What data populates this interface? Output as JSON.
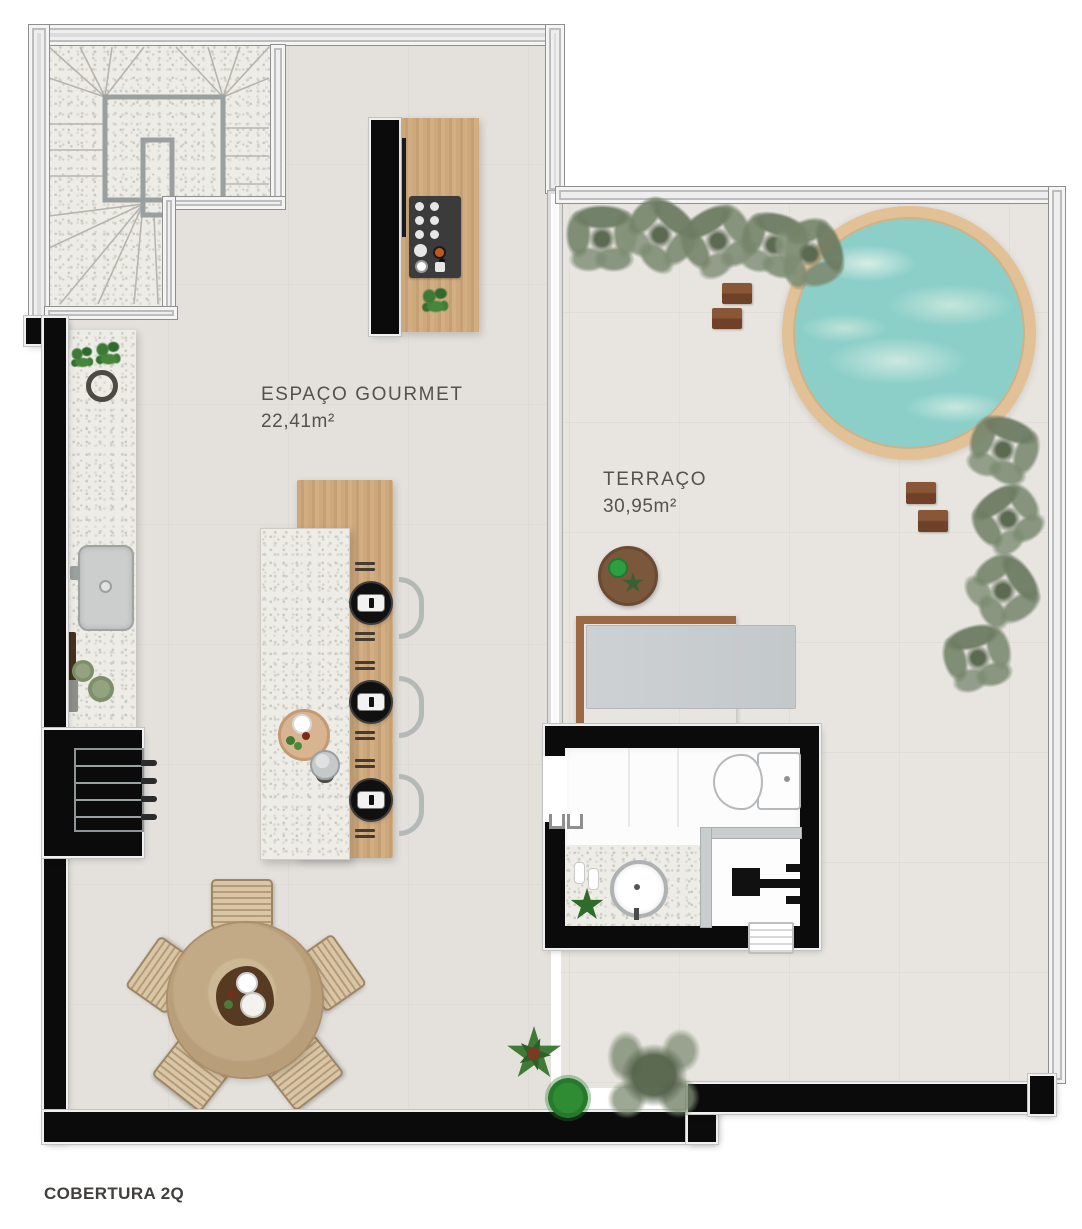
{
  "plan": {
    "title": "COBERTURA 2Q",
    "rooms": [
      {
        "id": "espaco-gourmet",
        "name": "ESPAÇO GOURMET",
        "area": "22,41m²"
      },
      {
        "id": "terraco",
        "name": "TERRAÇO",
        "area": "30,95m²"
      }
    ]
  },
  "palette": {
    "background": "#ffffff",
    "floor_indoor": "#e4e1dc",
    "floor_terrace": "#e8e5e0",
    "wall_black": "#0b0b0b",
    "wall_gray": "#dcdcdc",
    "granite": "#edece6",
    "wood_counter": "#cda87c",
    "wood_dining": "#c3aa87",
    "wood_deck": "#9b6a45",
    "pool_water": "#8ccfc9",
    "pool_rim": "#e3c197",
    "foliage_sage": "#7c8b72",
    "foliage_green": "#2f8c33",
    "label_text": "#54524d"
  }
}
